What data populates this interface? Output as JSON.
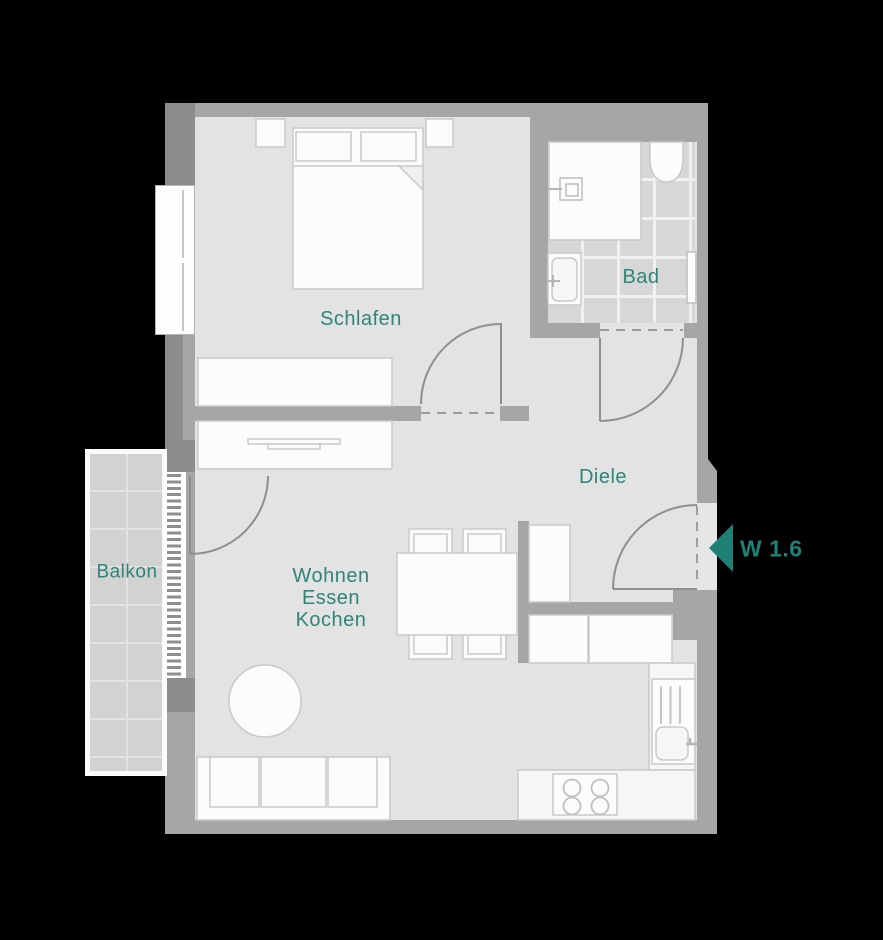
{
  "unit": {
    "label": "W 1.6",
    "entrance_arrow_icon": "left-pointing-triangle"
  },
  "rooms": {
    "bedroom": {
      "label": "Schlafen"
    },
    "bathroom": {
      "label": "Bad"
    },
    "hallway": {
      "label": "Diele"
    },
    "living": {
      "label": "Wohnen\nEssen\nKochen"
    },
    "balcony": {
      "label": "Balkon"
    }
  },
  "colors": {
    "background": "#000000",
    "floor": "#e3e3e3",
    "wall": "#a6a6a6",
    "wall_dark": "#8d8d8d",
    "tile": "#d7d7d7",
    "tile_grout": "#f0f0f0",
    "balcony_tile": "#d2d2d2",
    "balcony_grout": "#e2e2e2",
    "furniture": "#fcfcfc",
    "outline": "#c9c9c9",
    "door_line": "#8f8f8f",
    "accent": "#2f8577",
    "unit_accent": "#1f8076"
  }
}
